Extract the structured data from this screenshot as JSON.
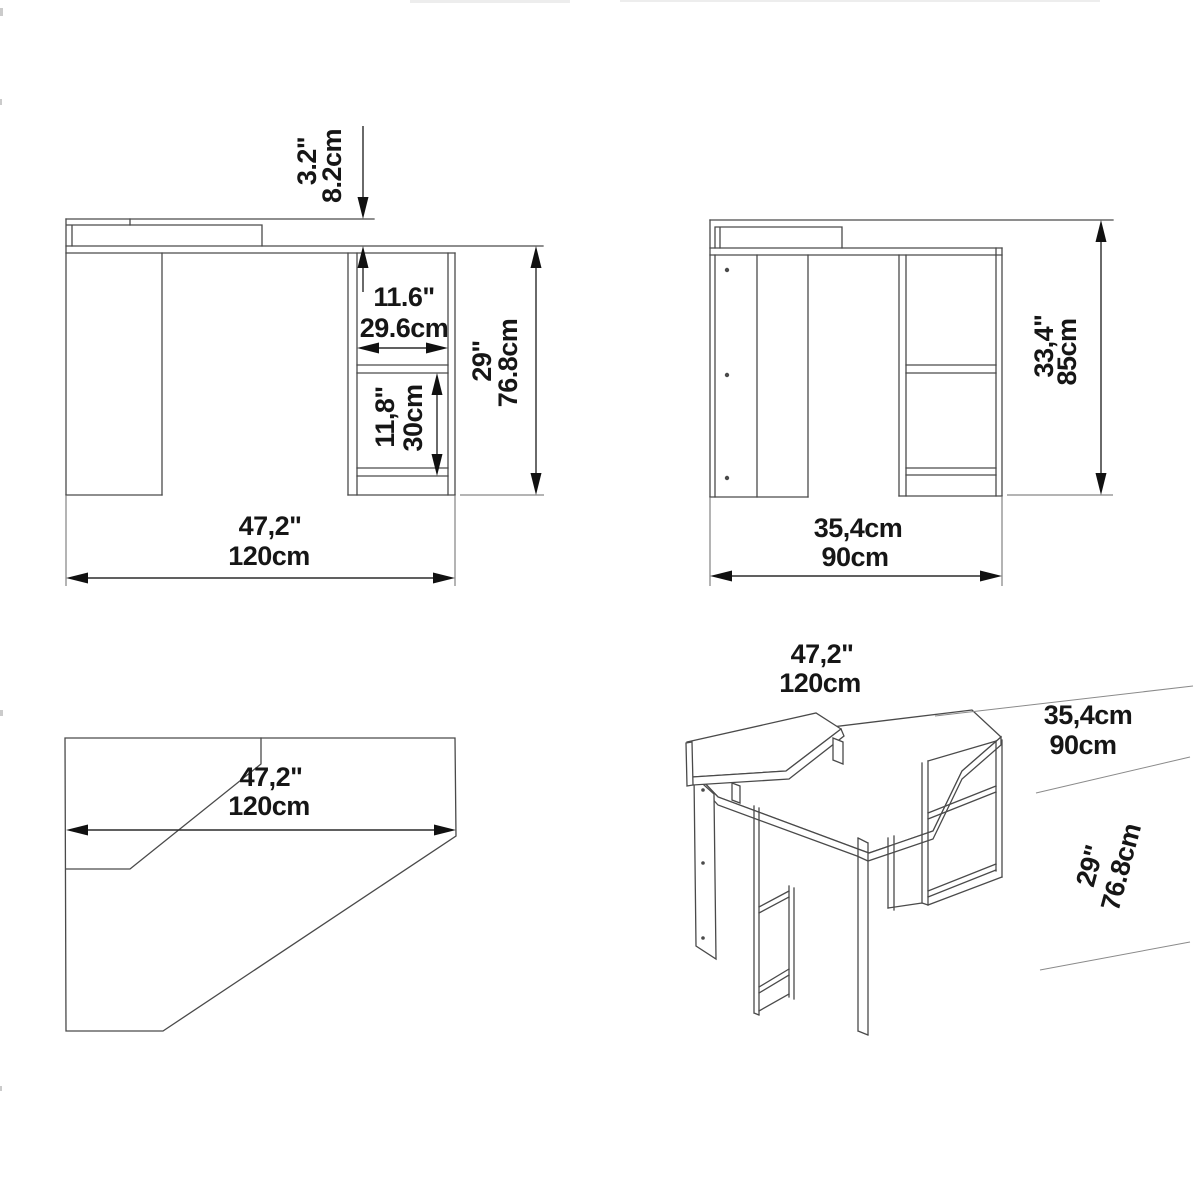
{
  "document": {
    "type": "furniture-dimension-drawing",
    "subject": "corner-desk",
    "background": "#ffffff",
    "line_color": "#4a4a4a",
    "dimension_color": "#2b2b2b",
    "text_color": "#161616"
  },
  "front_view": {
    "riser_height_in": "3.2\"",
    "riser_height_cm": "8.2cm",
    "niche_width_in": "11.6\"",
    "niche_width_cm": "29.6cm",
    "niche_height_in": "11,8\"",
    "niche_height_cm": "30cm",
    "desk_height_in": "29\"",
    "desk_height_cm": "76.8cm",
    "width_in": "47,2\"",
    "width_cm": "120cm"
  },
  "side_view": {
    "total_height_in": "33,4\"",
    "total_height_cm": "85cm",
    "depth_a": "35,4cm",
    "depth_b": "90cm"
  },
  "plan_view": {
    "width_in": "47,2\"",
    "width_cm": "120cm"
  },
  "iso_view": {
    "width_in": "47,2\"",
    "width_cm": "120cm",
    "depth_a": "35,4cm",
    "depth_b": "90cm",
    "height_in": "29\"",
    "height_cm": "76.8cm"
  }
}
